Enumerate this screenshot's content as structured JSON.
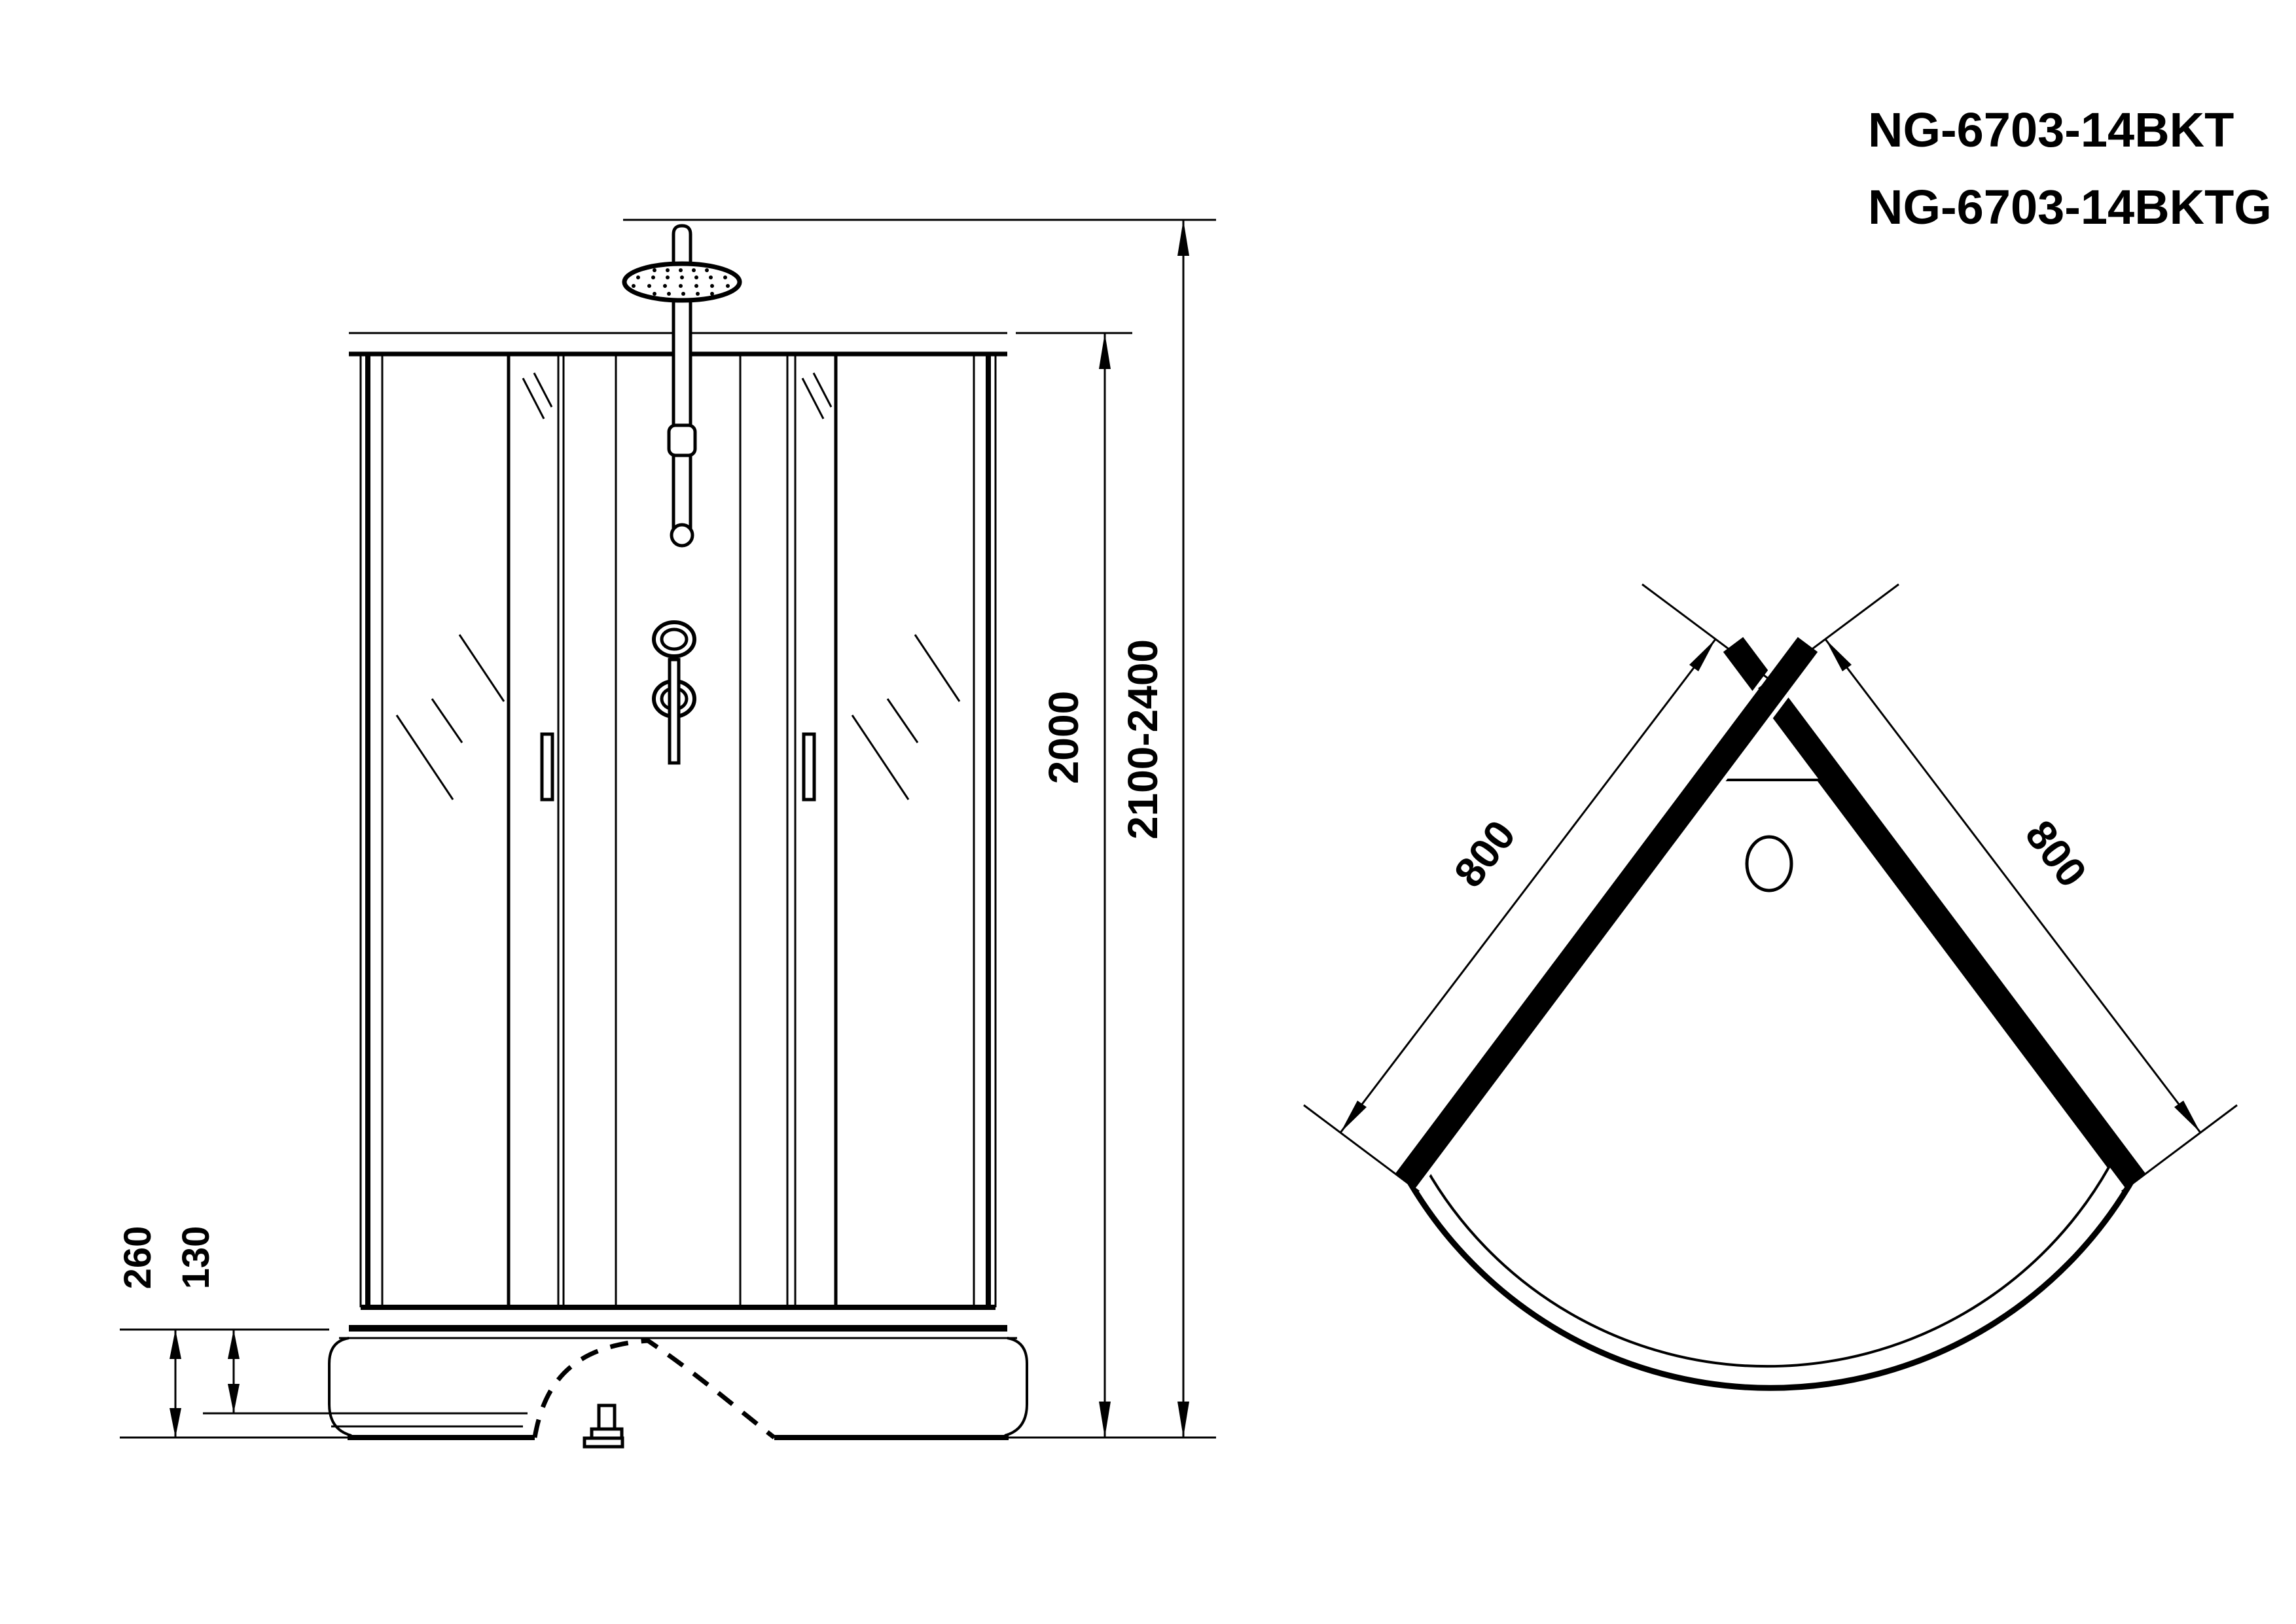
{
  "meta": {
    "drawing_type": "shower cabin technical drawing",
    "colors": {
      "ink": "#000000",
      "background": "#ffffff"
    }
  },
  "product": {
    "models": [
      "NG-6703-14BKT",
      "NG-6703-14BKTG"
    ]
  },
  "front_view": {
    "dimensions": {
      "cabin_height": "2000",
      "total_height": "2100-2400",
      "base_height": "260",
      "base_step_height": "130"
    }
  },
  "plan_view": {
    "dimensions": {
      "side_a": "800",
      "side_b": "800"
    }
  }
}
